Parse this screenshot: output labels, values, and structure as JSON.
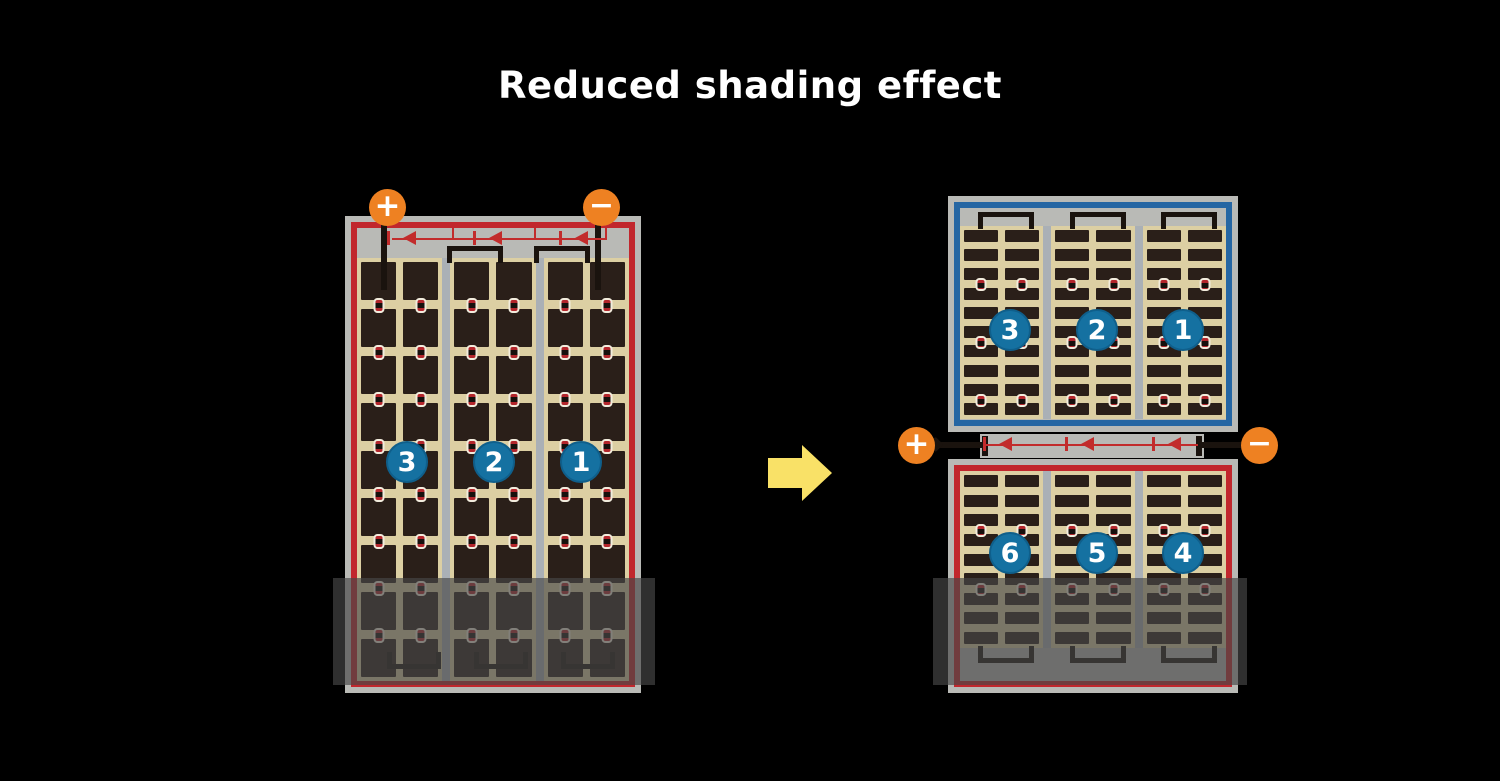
{
  "title": "Reduced shading effect",
  "terminals": {
    "plus": "+",
    "minus": "−"
  },
  "before_diagram": {
    "groups": [
      "3",
      "2",
      "1"
    ],
    "shading": true
  },
  "after_diagram": {
    "top_groups": [
      "3",
      "2",
      "1"
    ],
    "bottom_groups": [
      "6",
      "5",
      "4"
    ],
    "shading": true
  },
  "panels": {
    "left": {
      "columns": 3,
      "subcols": 2,
      "rows": 9,
      "dot_every": 1
    },
    "right_top": {
      "columns": 3,
      "subcols": 2,
      "rows": 10,
      "dot_every": 3
    },
    "right_bottom": {
      "columns": 3,
      "subcols": 2,
      "rows": 9,
      "dot_every": 3
    }
  },
  "icons": {
    "bypass_diode": "left-pointing-triangle-diode",
    "transition_arrow": "right-arrow",
    "positive_terminal": "plus-circle",
    "negative_terminal": "minus-circle"
  },
  "colors": {
    "background": "#000000",
    "title_text": "#ffffff",
    "panel_frame": "#b9bab6",
    "separator": "#aab0b6",
    "cell_field": "#dccfa3",
    "cell": "#2a1f19",
    "string_border_red": "#c1272d",
    "string_border_blue": "#2566a3",
    "terminal_orange": "#ee8122",
    "group_badge_blue": "#1571a1",
    "diode_red": "#c22c2c",
    "wire_black": "#1a130e",
    "arrow_yellow": "#f9e167",
    "shade": "rgba(72,72,72,0.66)"
  }
}
